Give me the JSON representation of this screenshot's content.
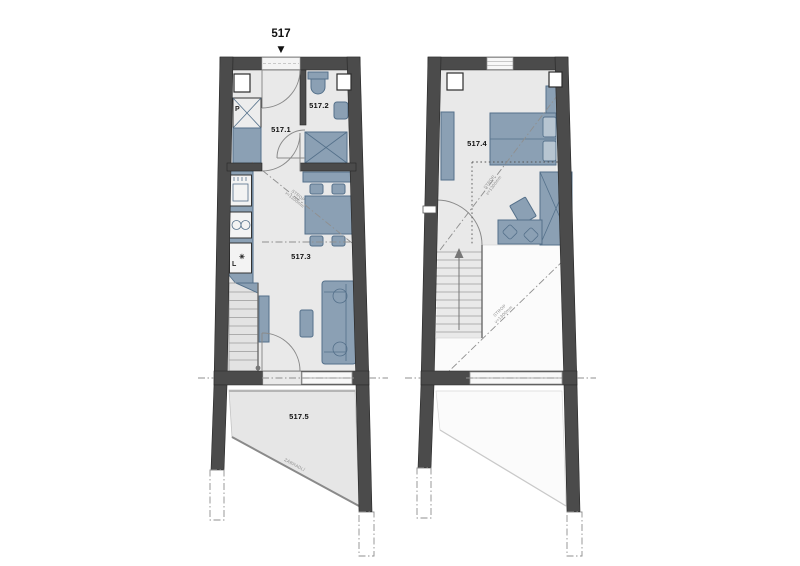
{
  "unit": {
    "label": "517"
  },
  "rooms": {
    "hall": {
      "label": "517.1"
    },
    "bathroom": {
      "label": "517.2"
    },
    "living": {
      "label": "517.3"
    },
    "bedroom": {
      "label": "517.4"
    },
    "terrace": {
      "label": "517.5"
    }
  },
  "appliances": {
    "washer": "P",
    "fridge": "L",
    "fridge_symbol": "✳"
  },
  "annotations": {
    "ceiling_line1": "STROP",
    "ceiling_line2": "v=1300mm",
    "railing": "ZÁBRADLÍ"
  },
  "icons": {
    "entry_arrow": "▼"
  },
  "colors": {
    "wall": "#4b4b4b",
    "wall_edge": "#262626",
    "floor": "#e9e9e9",
    "terrace": "#e6e6e6",
    "void": "#fbfbfb",
    "furniture": "#8ba0b4",
    "furniture_stroke": "#54708a",
    "furniture_light": "#b7c5d1",
    "fixture": "#f3f3f3",
    "line": "#8f8f8f",
    "anno": "#8c8c8c",
    "text": "#111111",
    "bg": "#ffffff"
  }
}
